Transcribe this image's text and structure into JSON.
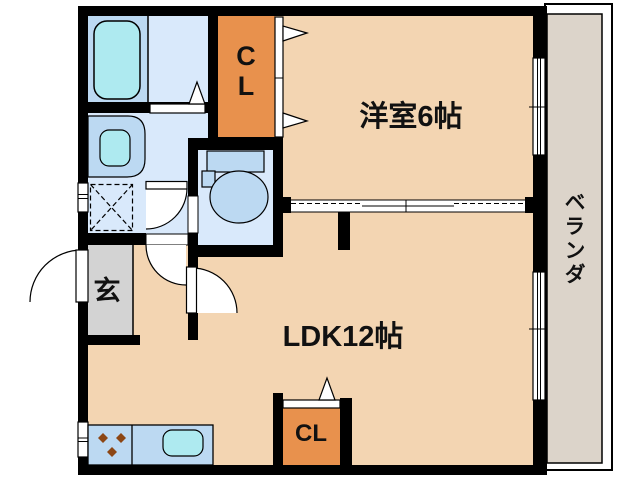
{
  "floor_plan": {
    "rooms": {
      "western_room": {
        "label": "洋室6帖"
      },
      "ldk": {
        "label": "LDK12帖"
      },
      "entrance": {
        "label": "玄"
      },
      "veranda": {
        "label": "ベランダ"
      },
      "closet_upper": {
        "label": "CL"
      },
      "closet_lower": {
        "label": "CL"
      }
    },
    "fixtures": [
      "bathtub",
      "washbasin",
      "washing-machine-space",
      "toilet",
      "kitchen-counter",
      "gas-stove-burners",
      "kitchen-sink",
      "sliding-partition",
      "windows",
      "hinged-doors"
    ],
    "colors": {
      "wall": "#000000",
      "room_floor": "#f3d5b2",
      "closet_orange": "#e8914d",
      "wet_area_floor": "#d9e9fb",
      "fixture_blue": "#bcd9f2",
      "fixture_cyan": "#aeeaf0",
      "genkan_gray": "#d3d3d3",
      "veranda_gray": "#dcd4ca",
      "burner_brown": "#8c4614"
    }
  }
}
